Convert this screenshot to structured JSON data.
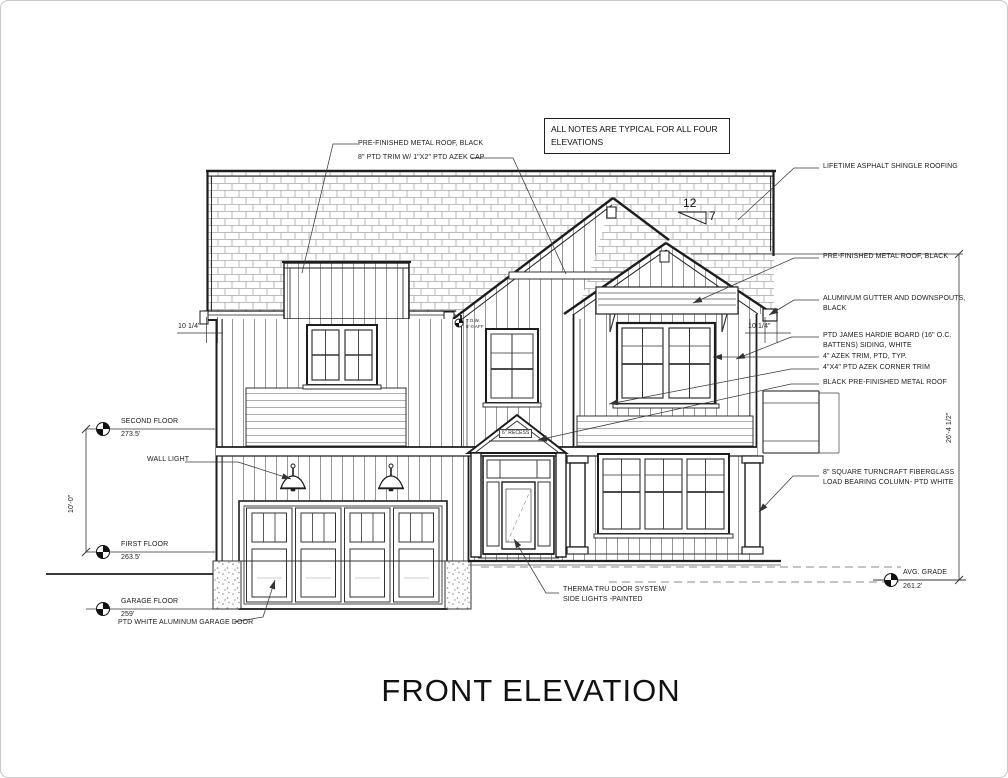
{
  "title": "FRONT ELEVATION",
  "notes_box": {
    "line1": "ALL NOTES ARE TYPICAL FOR ALL FOUR",
    "line2": "ELEVATIONS"
  },
  "notes": {
    "metal_roof_top": "PRE-FINISHED METAL ROOF, BLACK",
    "azek_cap": "8\" PTD TRIM W/ 1\"X2\" PTD AZEK CAP",
    "shingle": "LIFETIME ASPHALT SHINGLE ROOFING",
    "metal_roof_right": "PRE-FINISHED METAL ROOF, BLACK",
    "gutter_l1": "ALUMINUM GUTTER AND DOWNSPOUTS,",
    "gutter_l2": "BLACK",
    "hardie_l1": "PTD JAMES HARDIE BOARD (16\" O.C.",
    "hardie_l2": "BATTENS) SIDING, WHITE",
    "azek_trim": "4\" AZEK TRIM, PTD, TYP.",
    "corner_trim": "4\"X4\" PTD AZEK CORNER TRIM",
    "black_metal_roof": "BLACK PRE-FINISHED METAL ROOF",
    "column_l1": "8\" SQUARE TURNCRAFT FIBERGLASS",
    "column_l2": "LOAD BEARING COLUMN- PTD WHITE",
    "wall_light": "WALL LIGHT",
    "garage_door": "PTD WHITE ALUMINUM GARAGE DOOR",
    "therma_l1": "THERMA TRU DOOR SYSTEM/",
    "therma_l2": "SIDE LIGHTS -PAINTED",
    "recess": "6\" RECESS",
    "tow_l1": "T.O.W.",
    "tow_l2": "8'-0 AFF"
  },
  "levels": {
    "second": {
      "name": "SECOND FLOOR",
      "elev": "273.5'"
    },
    "first": {
      "name": "FIRST FLOOR",
      "elev": "263.5'"
    },
    "garage": {
      "name": "GARAGE FLOOR",
      "elev": "259'"
    },
    "grade": {
      "name": "AVG. GRADE",
      "elev": "261.2'"
    }
  },
  "dimensions": {
    "floor_to_floor": "10'-0\"",
    "overall": "26'-4 1/2\"",
    "eave_left": "10 1/4\"",
    "eave_right": "10 1/4\"",
    "slope_run": "12",
    "slope_rise": "7"
  }
}
